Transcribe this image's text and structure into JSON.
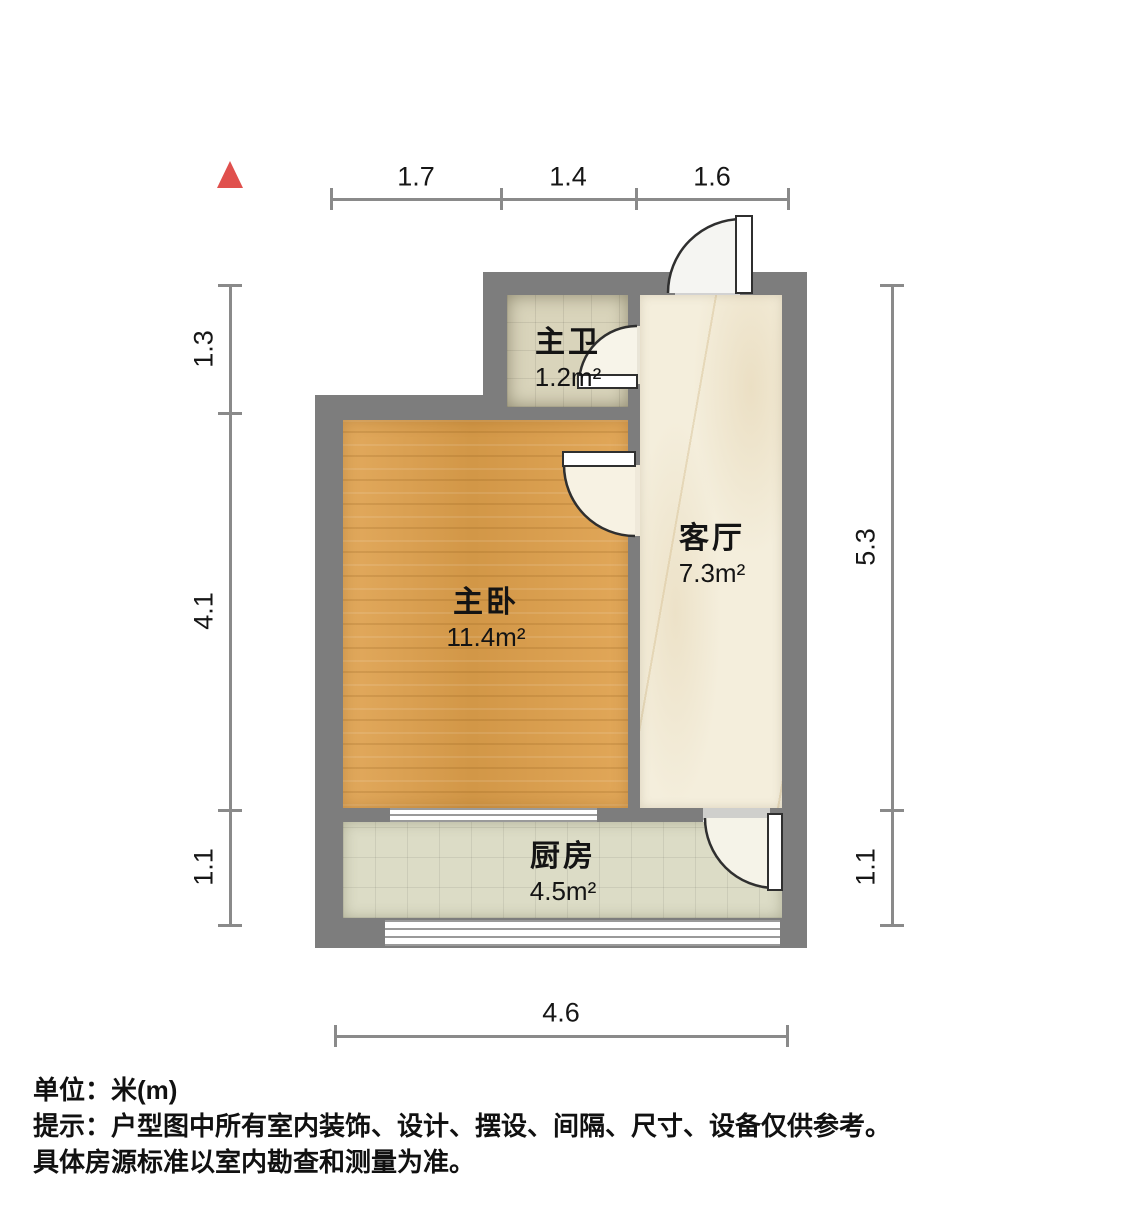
{
  "north_arrow": {
    "icon": "north-triangle",
    "color": "#e0504d"
  },
  "rooms": [
    {
      "name": "主卫",
      "area": "1.2m²",
      "floor_color": "#d9d4bb"
    },
    {
      "name": "客厅",
      "area": "7.3m²",
      "floor_color": "#f4eedc"
    },
    {
      "name": "主卧",
      "area": "11.4m²",
      "floor_color": "#dfa04b"
    },
    {
      "name": "厨房",
      "area": "4.5m²",
      "floor_color": "#dcdcc6"
    }
  ],
  "dimensions": {
    "top": [
      "1.7",
      "1.4",
      "1.6"
    ],
    "left": [
      "1.3",
      "4.1",
      "1.1"
    ],
    "right": [
      "5.3",
      "1.1"
    ],
    "bottom": [
      "4.6"
    ]
  },
  "footer": {
    "unit_label": "单位：米(m)",
    "note_line1": "提示：户型图中所有室内装饰、设计、摆设、间隔、尺寸、设备仅供参考。",
    "note_line2": "具体房源标准以室内勘查和测量为准。"
  },
  "colors": {
    "wall": "#7d7d7d",
    "dimension_line": "#8a8a8a",
    "door_stroke": "#2f2f2f",
    "north_arrow": "#e0504d"
  }
}
